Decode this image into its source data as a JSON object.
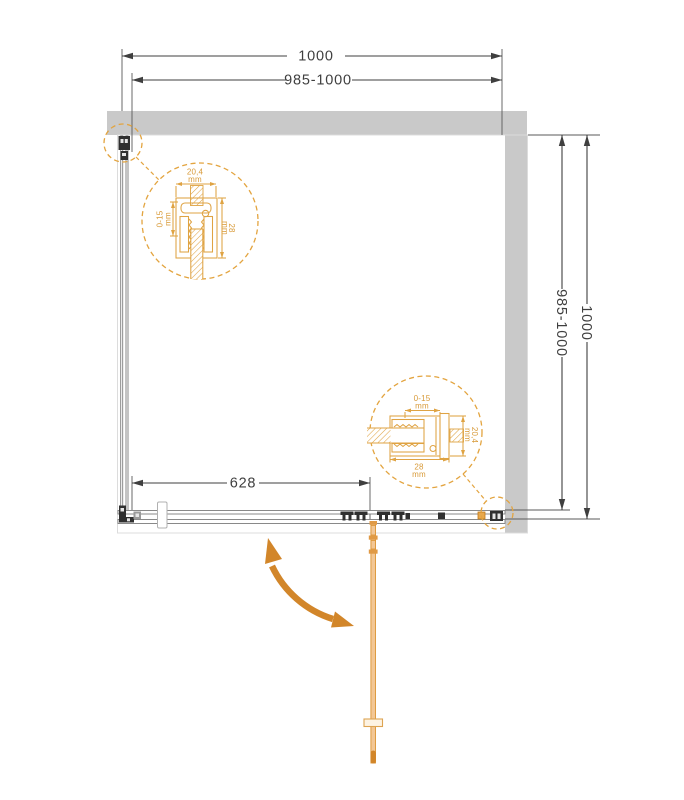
{
  "plan": {
    "dimensions": {
      "top_outer": "1000",
      "top_adjustable": "985-1000",
      "side_adjustable": "985-1000",
      "side_outer": "1000",
      "door_width": "628"
    },
    "detail_top": {
      "profile_width": "20,4",
      "profile_width_unit": "mm",
      "adjustment": "0-15",
      "adjustment_unit": "mm",
      "profile_depth": "28",
      "profile_depth_unit": "mm"
    },
    "detail_side": {
      "adjustment": "0-15",
      "adjustment_unit": "mm",
      "profile_depth": "28",
      "profile_depth_unit": "mm",
      "profile_width": "20,4",
      "profile_width_unit": "mm"
    },
    "colors": {
      "wall": "#c9c9c9",
      "dimension_line": "#3f3f3f",
      "accent": "#dfa343",
      "accent_dark": "#d2862a",
      "door_fill": "#f3c795"
    }
  }
}
